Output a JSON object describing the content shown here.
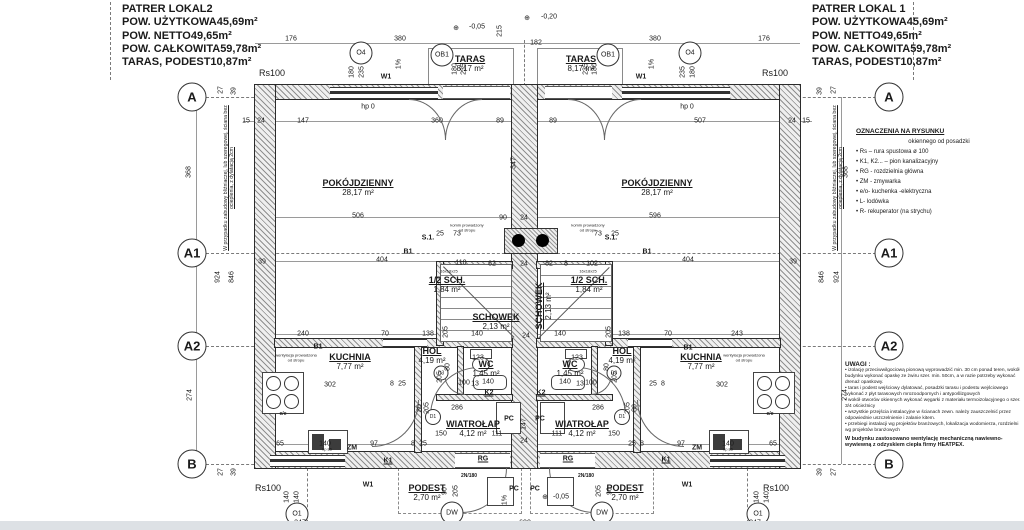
{
  "title_block_left": {
    "title": "PATRER LOKAL2",
    "rows": [
      {
        "label": "POW. UŻYTKOWA",
        "value": "45,69m²"
      },
      {
        "label": "POW. NETTO",
        "value": "49,65m²"
      },
      {
        "label": "POW. CAŁKOWITA",
        "value": "59,78m²"
      },
      {
        "label": "TARAS, PODEST",
        "value": "10,87m²"
      }
    ]
  },
  "title_block_right": {
    "title": "PATRER LOKAL 1",
    "rows": [
      {
        "label": "POW. UŻYTKOWA",
        "value": "45,69m²"
      },
      {
        "label": "POW. NETTO",
        "value": "49,65m²"
      },
      {
        "label": "POW. CAŁKOWITA",
        "value": "59,78m²"
      },
      {
        "label": "TARAS, PODEST",
        "value": "10,87m²"
      }
    ]
  },
  "legend": {
    "title": "OZNACZENIA NA RYSUNKU",
    "subtitle": "okiennego od posadzki",
    "items": [
      "• Rs – rura spustowa ø 100",
      "• K1, K2... – pion kanalizacyjny",
      "• RG - rozdzielnia główna",
      "• ZM - zmywarka",
      "• e/o- kuchenka -elektryczna",
      "• L- lodówka",
      "• R- rekuperator (na strychu)"
    ]
  },
  "notes": {
    "title": "UWAGI :",
    "items": [
      "• izolację przeciwwilgociową pionową wyprowadzić min. 30 cm ponad teren, wokół budynku wykonać opaskę ze żwiru szer. min. 50cm, a w razie potrzeby wykonać drenaż opaskowy.",
      "• taras i podest wejściowy dylatować, posadzki tarasu i podestu wejściowego wykonać z płyt tarasowych mrozoodpornych i antypoślizgowych",
      "• wokół otworów okiennych wykonać węgarki z materiału termoizolacyjnego o szer. 3/4 ościeżnicy",
      "• wszystkie przejścia instalacyjne w ścianach zewn. należy zauszczelnić przez odpowiednie uszczelnienie i zalanie kitem.",
      "• przebiegi instalacji wg projektów branżowych, lokalizacja wodomierza, rozdzielni wg projektów branżowych"
    ],
    "footer": "W budynku zastosowano wentylację mechaniczną nawiewno-wywiewną z odzyskiem ciepła firmy HEATPEX."
  },
  "side_note": "W przypadku zabudowy bliźniaczej, lub szeregowej, ściana bez ocieplenia, z dylatacją 2cm",
  "grid": {
    "rows": [
      {
        "label": "A",
        "y": 97
      },
      {
        "label": "A1",
        "y": 253
      },
      {
        "label": "A2",
        "y": 346
      },
      {
        "label": "B",
        "y": 464
      }
    ]
  },
  "rooms": [
    {
      "name": "POKÓJDZIENNY",
      "area": "28,17 m²",
      "x": 358,
      "y": 188
    },
    {
      "name": "POKÓJDZIENNY",
      "area": "28,17 m²",
      "x": 657,
      "y": 188
    },
    {
      "name": "TARAS",
      "area": "8,17 m²",
      "x": 470,
      "y": 64
    },
    {
      "name": "TARAS",
      "area": "8,17 m²",
      "x": 581,
      "y": 64
    },
    {
      "name": "KUCHNIA",
      "area": "7,77 m²",
      "x": 350,
      "y": 362
    },
    {
      "name": "KUCHNIA",
      "area": "7,77 m²",
      "x": 701,
      "y": 362
    },
    {
      "name": "HOL",
      "area": "4,19 m²",
      "x": 432,
      "y": 356
    },
    {
      "name": "HOL",
      "area": "4,19 m²",
      "x": 622,
      "y": 356
    },
    {
      "name": "WC",
      "area": "1,45 m²",
      "x": 486,
      "y": 369
    },
    {
      "name": "WC",
      "area": "1,45 m²",
      "x": 570,
      "y": 369
    },
    {
      "name": "1/2 SCH.",
      "area": "1,84 m²",
      "x": 447,
      "y": 285
    },
    {
      "name": "1/2 SCH.",
      "area": "1,84 m²",
      "x": 589,
      "y": 285
    },
    {
      "name": "SCHOWEK",
      "area": "2,13 m²",
      "x": 496,
      "y": 322
    },
    {
      "name": "SCHOWEK",
      "area": "2,13 m²",
      "x": 544,
      "y": 306,
      "vert": true
    },
    {
      "name": "WIATROŁAP",
      "area": "4,12 m²",
      "x": 473,
      "y": 429
    },
    {
      "name": "WIATROŁAP",
      "area": "4,12 m²",
      "x": 582,
      "y": 429
    },
    {
      "name": "PODEST",
      "area": "2,70 m²",
      "x": 427,
      "y": 493
    },
    {
      "name": "PODEST",
      "area": "2,70 m²",
      "x": 625,
      "y": 493
    }
  ],
  "circle_labels": [
    {
      "t": "O4",
      "x": 361,
      "y": 53,
      "d": 21
    },
    {
      "t": "O4",
      "x": 690,
      "y": 53,
      "d": 21
    },
    {
      "t": "OB1",
      "x": 442,
      "y": 55,
      "d": 21
    },
    {
      "t": "OB1",
      "x": 608,
      "y": 55,
      "d": 21
    },
    {
      "t": "O1",
      "x": 297,
      "y": 514,
      "d": 21
    },
    {
      "t": "O1",
      "x": 758,
      "y": 514,
      "d": 21
    },
    {
      "t": "DW",
      "x": 452,
      "y": 513,
      "d": 21
    },
    {
      "t": "DW",
      "x": 602,
      "y": 513,
      "d": 21
    },
    {
      "t": "D1",
      "x": 433,
      "y": 417,
      "d": 14
    },
    {
      "t": "D1",
      "x": 622,
      "y": 417,
      "d": 14
    },
    {
      "t": "D3",
      "x": 441,
      "y": 373,
      "d": 13
    },
    {
      "t": "D3",
      "x": 614,
      "y": 373,
      "d": 13
    }
  ],
  "labels": [
    {
      "t": "176",
      "x": 291,
      "y": 39
    },
    {
      "t": "380",
      "x": 400,
      "y": 39
    },
    {
      "t": "215",
      "x": 500,
      "y": 31,
      "r": 1
    },
    {
      "t": "182",
      "x": 536,
      "y": 43
    },
    {
      "t": "380",
      "x": 655,
      "y": 39
    },
    {
      "t": "176",
      "x": 764,
      "y": 39
    },
    {
      "t": "⊕",
      "x": 456,
      "y": 28
    },
    {
      "t": "-0,05",
      "x": 477,
      "y": 27
    },
    {
      "t": "⊕",
      "x": 527,
      "y": 18
    },
    {
      "t": "-0,20",
      "x": 549,
      "y": 17
    },
    {
      "t": "180",
      "x": 352,
      "y": 72,
      "r": 1
    },
    {
      "t": "235",
      "x": 362,
      "y": 72,
      "r": 1
    },
    {
      "t": "235",
      "x": 683,
      "y": 72,
      "r": 1
    },
    {
      "t": "180",
      "x": 693,
      "y": 72,
      "r": 1
    },
    {
      "t": "180",
      "x": 455,
      "y": 69,
      "r": 1
    },
    {
      "t": "235",
      "x": 464,
      "y": 69,
      "r": 1
    },
    {
      "t": "235",
      "x": 586,
      "y": 69,
      "r": 1
    },
    {
      "t": "180",
      "x": 595,
      "y": 69,
      "r": 1
    },
    {
      "t": "1%",
      "x": 399,
      "y": 64,
      "r": 1
    },
    {
      "t": "1%",
      "x": 652,
      "y": 64,
      "r": 1
    },
    {
      "t": "W1",
      "x": 386,
      "y": 77,
      "b": 1
    },
    {
      "t": "W1",
      "x": 641,
      "y": 77,
      "b": 1
    },
    {
      "t": "Rs100",
      "x": 272,
      "y": 73,
      "s": 9
    },
    {
      "t": "Rs100",
      "x": 775,
      "y": 73,
      "s": 9
    },
    {
      "t": "hp 0",
      "x": 368,
      "y": 107
    },
    {
      "t": "hp 0",
      "x": 687,
      "y": 107
    },
    {
      "t": "15",
      "x": 246,
      "y": 121
    },
    {
      "t": "24",
      "x": 261,
      "y": 121
    },
    {
      "t": "147",
      "x": 303,
      "y": 121
    },
    {
      "t": "360",
      "x": 437,
      "y": 121
    },
    {
      "t": "89",
      "x": 500,
      "y": 121
    },
    {
      "t": "89",
      "x": 553,
      "y": 121
    },
    {
      "t": "507",
      "x": 700,
      "y": 121
    },
    {
      "t": "24",
      "x": 792,
      "y": 121
    },
    {
      "t": "15",
      "x": 806,
      "y": 121
    },
    {
      "t": "27",
      "x": 221,
      "y": 90,
      "r": 1
    },
    {
      "t": "39",
      "x": 234,
      "y": 91,
      "r": 1
    },
    {
      "t": "39",
      "x": 820,
      "y": 91,
      "r": 1
    },
    {
      "t": "27",
      "x": 834,
      "y": 90,
      "r": 1
    },
    {
      "t": "368",
      "x": 189,
      "y": 172,
      "r": 1
    },
    {
      "t": "368",
      "x": 846,
      "y": 172,
      "r": 1
    },
    {
      "t": "924",
      "x": 218,
      "y": 277,
      "r": 1
    },
    {
      "t": "846",
      "x": 232,
      "y": 277,
      "r": 1
    },
    {
      "t": "846",
      "x": 822,
      "y": 277,
      "r": 1
    },
    {
      "t": "924",
      "x": 837,
      "y": 277,
      "r": 1
    },
    {
      "t": "274",
      "x": 190,
      "y": 395,
      "r": 1
    },
    {
      "t": "274",
      "x": 845,
      "y": 395,
      "r": 1
    },
    {
      "t": "27",
      "x": 221,
      "y": 472,
      "r": 1
    },
    {
      "t": "39",
      "x": 234,
      "y": 472,
      "r": 1
    },
    {
      "t": "39",
      "x": 820,
      "y": 472,
      "r": 1
    },
    {
      "t": "27",
      "x": 834,
      "y": 472,
      "r": 1
    },
    {
      "t": "506",
      "x": 358,
      "y": 216
    },
    {
      "t": "90",
      "x": 503,
      "y": 218
    },
    {
      "t": "24",
      "x": 524,
      "y": 218
    },
    {
      "t": "596",
      "x": 655,
      "y": 216
    },
    {
      "t": "347",
      "x": 514,
      "y": 163,
      "r": 1
    },
    {
      "t": "404",
      "x": 382,
      "y": 260
    },
    {
      "t": "404",
      "x": 688,
      "y": 260
    },
    {
      "t": "39",
      "x": 262,
      "y": 262
    },
    {
      "t": "39",
      "x": 793,
      "y": 262
    },
    {
      "t": "B1",
      "x": 408,
      "y": 252,
      "b": 1
    },
    {
      "t": "B1",
      "x": 647,
      "y": 252,
      "b": 1
    },
    {
      "t": "S.1.",
      "x": 428,
      "y": 238,
      "b": 1
    },
    {
      "t": "S.1.",
      "x": 611,
      "y": 238,
      "b": 1
    },
    {
      "t": "komin prowadzony",
      "x": 467,
      "y": 225,
      "s": 4
    },
    {
      "t": "od stropu",
      "x": 467,
      "y": 230,
      "s": 4
    },
    {
      "t": "komin prowadzony",
      "x": 588,
      "y": 225,
      "s": 4
    },
    {
      "t": "od stropu",
      "x": 588,
      "y": 230,
      "s": 4
    },
    {
      "t": "25",
      "x": 440,
      "y": 234
    },
    {
      "t": "73",
      "x": 457,
      "y": 234
    },
    {
      "t": "73",
      "x": 598,
      "y": 234
    },
    {
      "t": "25",
      "x": 615,
      "y": 234
    },
    {
      "t": "110",
      "x": 461,
      "y": 263
    },
    {
      "t": "82",
      "x": 492,
      "y": 264
    },
    {
      "t": "24",
      "x": 524,
      "y": 264
    },
    {
      "t": "82",
      "x": 549,
      "y": 264
    },
    {
      "t": "8",
      "x": 566,
      "y": 264
    },
    {
      "t": "102",
      "x": 592,
      "y": 264
    },
    {
      "t": "16x18x25",
      "x": 449,
      "y": 271,
      "s": 4
    },
    {
      "t": "16x18x25",
      "x": 588,
      "y": 271,
      "s": 4
    },
    {
      "t": "140",
      "x": 477,
      "y": 334
    },
    {
      "t": "24",
      "x": 526,
      "y": 336
    },
    {
      "t": "140",
      "x": 560,
      "y": 334
    },
    {
      "t": "240",
      "x": 303,
      "y": 334
    },
    {
      "t": "70",
      "x": 385,
      "y": 334
    },
    {
      "t": "138",
      "x": 428,
      "y": 334
    },
    {
      "t": "138",
      "x": 624,
      "y": 334
    },
    {
      "t": "70",
      "x": 668,
      "y": 334
    },
    {
      "t": "243",
      "x": 737,
      "y": 334
    },
    {
      "t": "B1",
      "x": 318,
      "y": 347,
      "b": 1
    },
    {
      "t": "B1",
      "x": 688,
      "y": 348,
      "b": 1
    },
    {
      "t": "wentylacja prowadzona",
      "x": 296,
      "y": 355,
      "s": 4
    },
    {
      "t": "od stropu",
      "x": 296,
      "y": 360,
      "s": 4
    },
    {
      "t": "wentylacja prowadzona",
      "x": 744,
      "y": 355,
      "s": 4
    },
    {
      "t": "od stropu",
      "x": 744,
      "y": 360,
      "s": 4
    },
    {
      "t": "302",
      "x": 330,
      "y": 385
    },
    {
      "t": "8",
      "x": 392,
      "y": 384
    },
    {
      "t": "25",
      "x": 402,
      "y": 384
    },
    {
      "t": "25",
      "x": 653,
      "y": 384
    },
    {
      "t": "8",
      "x": 663,
      "y": 384
    },
    {
      "t": "302",
      "x": 722,
      "y": 385
    },
    {
      "t": "123",
      "x": 478,
      "y": 358
    },
    {
      "t": "123",
      "x": 577,
      "y": 358
    },
    {
      "t": "205",
      "x": 446,
      "y": 332,
      "r": 1
    },
    {
      "t": "205",
      "x": 609,
      "y": 332,
      "r": 1
    },
    {
      "t": "80",
      "x": 448,
      "y": 367,
      "r": 1
    },
    {
      "t": "205",
      "x": 440,
      "y": 377,
      "r": 1
    },
    {
      "t": "80",
      "x": 607,
      "y": 367,
      "r": 1
    },
    {
      "t": "205",
      "x": 615,
      "y": 377,
      "r": 1
    },
    {
      "t": "100",
      "x": 464,
      "y": 383
    },
    {
      "t": "13",
      "x": 475,
      "y": 384
    },
    {
      "t": "100",
      "x": 591,
      "y": 383
    },
    {
      "t": "13",
      "x": 580,
      "y": 384
    },
    {
      "t": "140",
      "x": 488,
      "y": 382
    },
    {
      "t": "140",
      "x": 565,
      "y": 382
    },
    {
      "t": "K2",
      "x": 489,
      "y": 393,
      "b": 1,
      "u": 1
    },
    {
      "t": "K2",
      "x": 541,
      "y": 393,
      "b": 1,
      "u": 1
    },
    {
      "t": "80",
      "x": 420,
      "y": 408,
      "r": 1
    },
    {
      "t": "205",
      "x": 427,
      "y": 408,
      "r": 1
    },
    {
      "t": "80",
      "x": 635,
      "y": 408,
      "r": 1
    },
    {
      "t": "205",
      "x": 628,
      "y": 408,
      "r": 1
    },
    {
      "t": "286",
      "x": 457,
      "y": 408
    },
    {
      "t": "286",
      "x": 598,
      "y": 408
    },
    {
      "t": "PC",
      "x": 509,
      "y": 419,
      "b": 1
    },
    {
      "t": "PC",
      "x": 540,
      "y": 419,
      "b": 1
    },
    {
      "t": "147",
      "x": 524,
      "y": 424,
      "r": 1
    },
    {
      "t": "150",
      "x": 441,
      "y": 434
    },
    {
      "t": "111",
      "x": 497,
      "y": 434
    },
    {
      "t": "24",
      "x": 524,
      "y": 441
    },
    {
      "t": "111",
      "x": 557,
      "y": 434
    },
    {
      "t": "150",
      "x": 614,
      "y": 434
    },
    {
      "t": "65",
      "x": 280,
      "y": 444
    },
    {
      "t": "140",
      "x": 325,
      "y": 444
    },
    {
      "t": "97",
      "x": 374,
      "y": 444
    },
    {
      "t": "8",
      "x": 413,
      "y": 444
    },
    {
      "t": "25",
      "x": 423,
      "y": 444
    },
    {
      "t": "25",
      "x": 632,
      "y": 444
    },
    {
      "t": "8",
      "x": 642,
      "y": 444
    },
    {
      "t": "97",
      "x": 681,
      "y": 444
    },
    {
      "t": "140",
      "x": 728,
      "y": 444
    },
    {
      "t": "65",
      "x": 773,
      "y": 444
    },
    {
      "t": "ZM",
      "x": 352,
      "y": 448,
      "b": 1
    },
    {
      "t": "ZM",
      "x": 697,
      "y": 448,
      "b": 1
    },
    {
      "t": "e/e",
      "x": 283,
      "y": 414,
      "s": 5,
      "b": 1
    },
    {
      "t": "e/e",
      "x": 770,
      "y": 414,
      "s": 5,
      "b": 1
    },
    {
      "t": "K1",
      "x": 388,
      "y": 461,
      "b": 1,
      "u": 1
    },
    {
      "t": "K1",
      "x": 666,
      "y": 460,
      "b": 1,
      "u": 1
    },
    {
      "t": "RG",
      "x": 483,
      "y": 459,
      "b": 1,
      "u": 1
    },
    {
      "t": "RG",
      "x": 568,
      "y": 459,
      "b": 1,
      "u": 1
    },
    {
      "t": "2N/180",
      "x": 469,
      "y": 476,
      "s": 5,
      "b": 1
    },
    {
      "t": "2N/180",
      "x": 586,
      "y": 476,
      "s": 5,
      "b": 1
    },
    {
      "t": "90",
      "x": 445,
      "y": 491,
      "r": 1
    },
    {
      "t": "205",
      "x": 456,
      "y": 491,
      "r": 1
    },
    {
      "t": "205",
      "x": 599,
      "y": 491,
      "r": 1
    },
    {
      "t": "90",
      "x": 610,
      "y": 491,
      "r": 1
    },
    {
      "t": "W1",
      "x": 368,
      "y": 485,
      "b": 1
    },
    {
      "t": "W1",
      "x": 687,
      "y": 485,
      "b": 1
    },
    {
      "t": "PC",
      "x": 514,
      "y": 489,
      "b": 1
    },
    {
      "t": "PC",
      "x": 535,
      "y": 489,
      "b": 1
    },
    {
      "t": "⊕",
      "x": 545,
      "y": 497
    },
    {
      "t": "-0,05",
      "x": 561,
      "y": 497
    },
    {
      "t": "1%",
      "x": 505,
      "y": 500,
      "r": 1
    },
    {
      "t": "140",
      "x": 287,
      "y": 497,
      "r": 1
    },
    {
      "t": "140",
      "x": 297,
      "y": 497,
      "r": 1
    },
    {
      "t": "140",
      "x": 757,
      "y": 497,
      "r": 1
    },
    {
      "t": "140",
      "x": 767,
      "y": 497,
      "r": 1
    },
    {
      "t": "347",
      "x": 300,
      "y": 523
    },
    {
      "t": "600",
      "x": 525,
      "y": 523
    },
    {
      "t": "347",
      "x": 755,
      "y": 523
    },
    {
      "t": "hp 85",
      "x": 327,
      "y": 449,
      "s": 4
    },
    {
      "t": "hp 85",
      "x": 728,
      "y": 449,
      "s": 4
    },
    {
      "t": "Rs100",
      "x": 268,
      "y": 488,
      "s": 9
    },
    {
      "t": "Rs100",
      "x": 776,
      "y": 488,
      "s": 9
    }
  ]
}
